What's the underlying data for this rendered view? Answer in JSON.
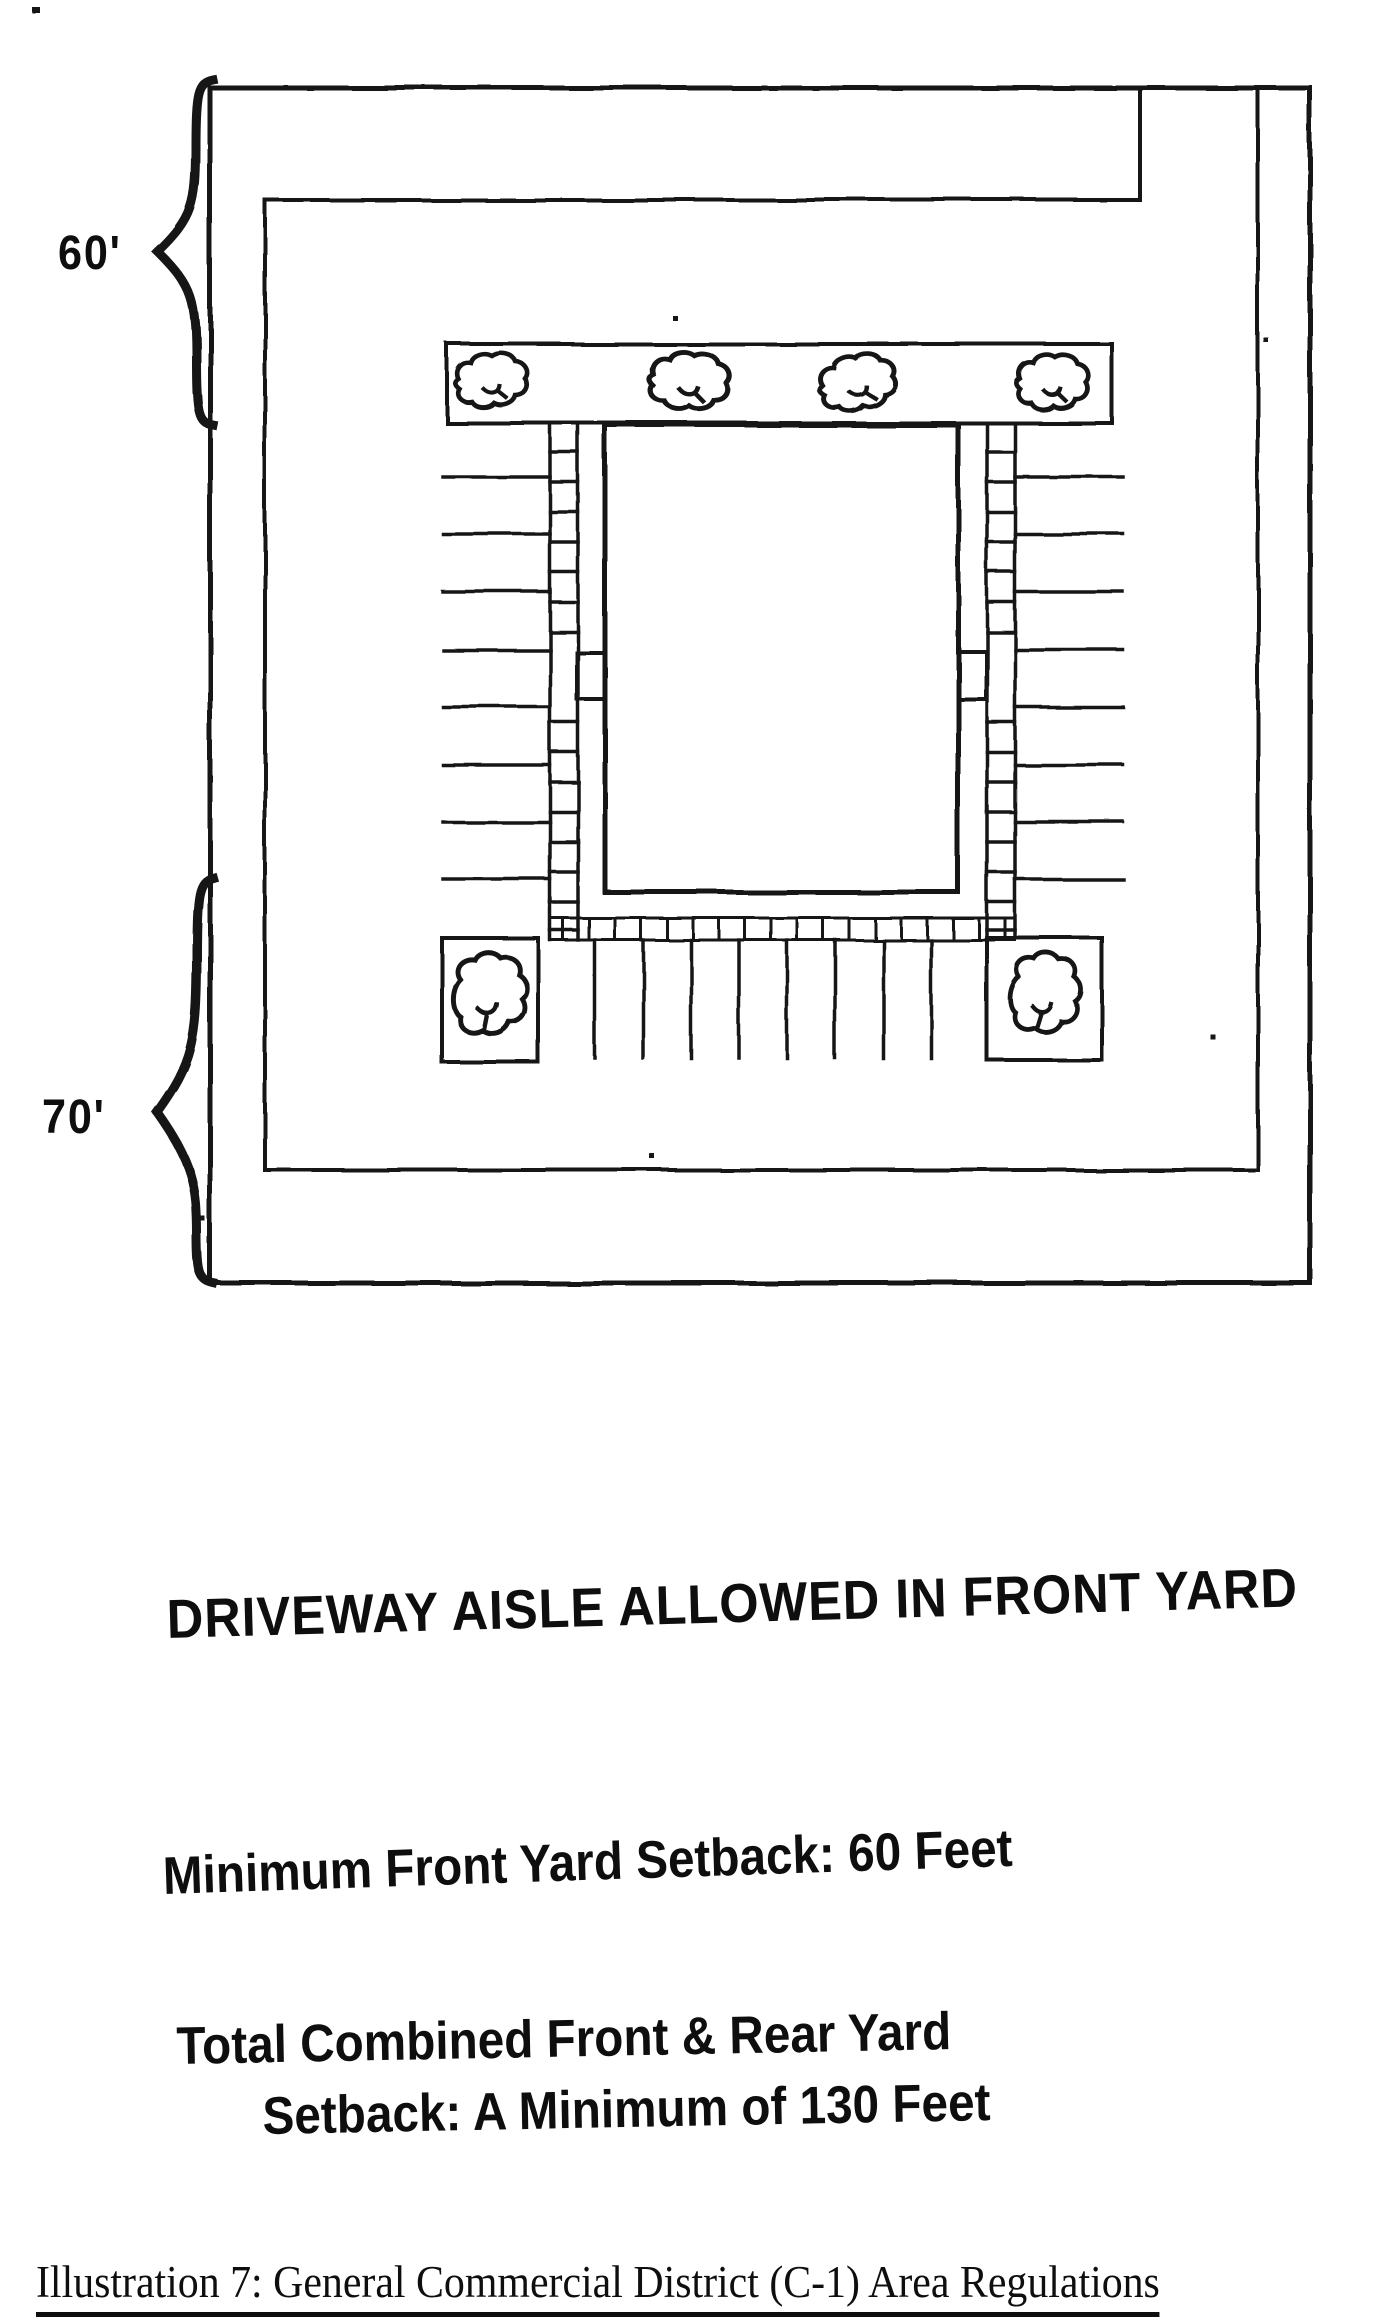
{
  "colors": {
    "paper": "#ffffff",
    "ink": "#141414"
  },
  "plan": {
    "front_dimension": "60'",
    "rear_dimension": "70'"
  },
  "notes": {
    "driveway": "DRIVEWAY AISLE ALLOWED IN FRONT YARD",
    "front_setback": "Minimum Front Yard Setback: 60 Feet",
    "combined_setback_line1": "Total Combined Front & Rear Yard",
    "combined_setback_line2": "Setback: A Minimum of 130 Feet"
  },
  "caption": "Illustration 7: General Commercial District (C-1) Area Regulations"
}
